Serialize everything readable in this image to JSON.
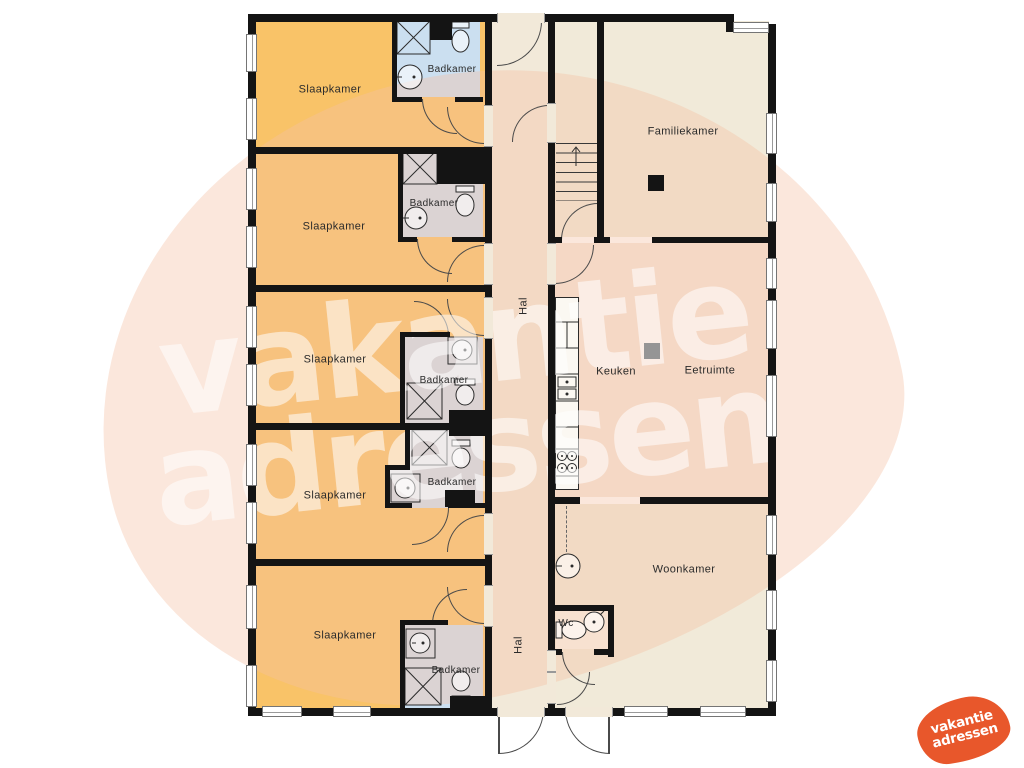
{
  "labels": {
    "slaapkamer": "Slaapkamer",
    "badkamer": "Badkamer",
    "hal": "Hal",
    "familiekamer": "Familiekamer",
    "keuken": "Keuken",
    "eetruimte": "Eetruimte",
    "woonkamer": "Woonkamer",
    "wc": "Wc"
  },
  "watermark": {
    "line1": "vakantie",
    "line2": "adressen"
  },
  "logo": {
    "line1": "vakantie",
    "line2": "adressen"
  },
  "colors": {
    "bedroom": "#f9c368",
    "bathroom": "#cbdff0",
    "hall": "#f2e9d9",
    "living": "#f1ead9",
    "kitchen": "#f6e7da",
    "wall": "#141414",
    "logo_orange": "#e8572b",
    "watermark_tint": "rgba(245,192,162,0.38)",
    "watermark_text": "rgba(255,255,255,0.55)"
  }
}
